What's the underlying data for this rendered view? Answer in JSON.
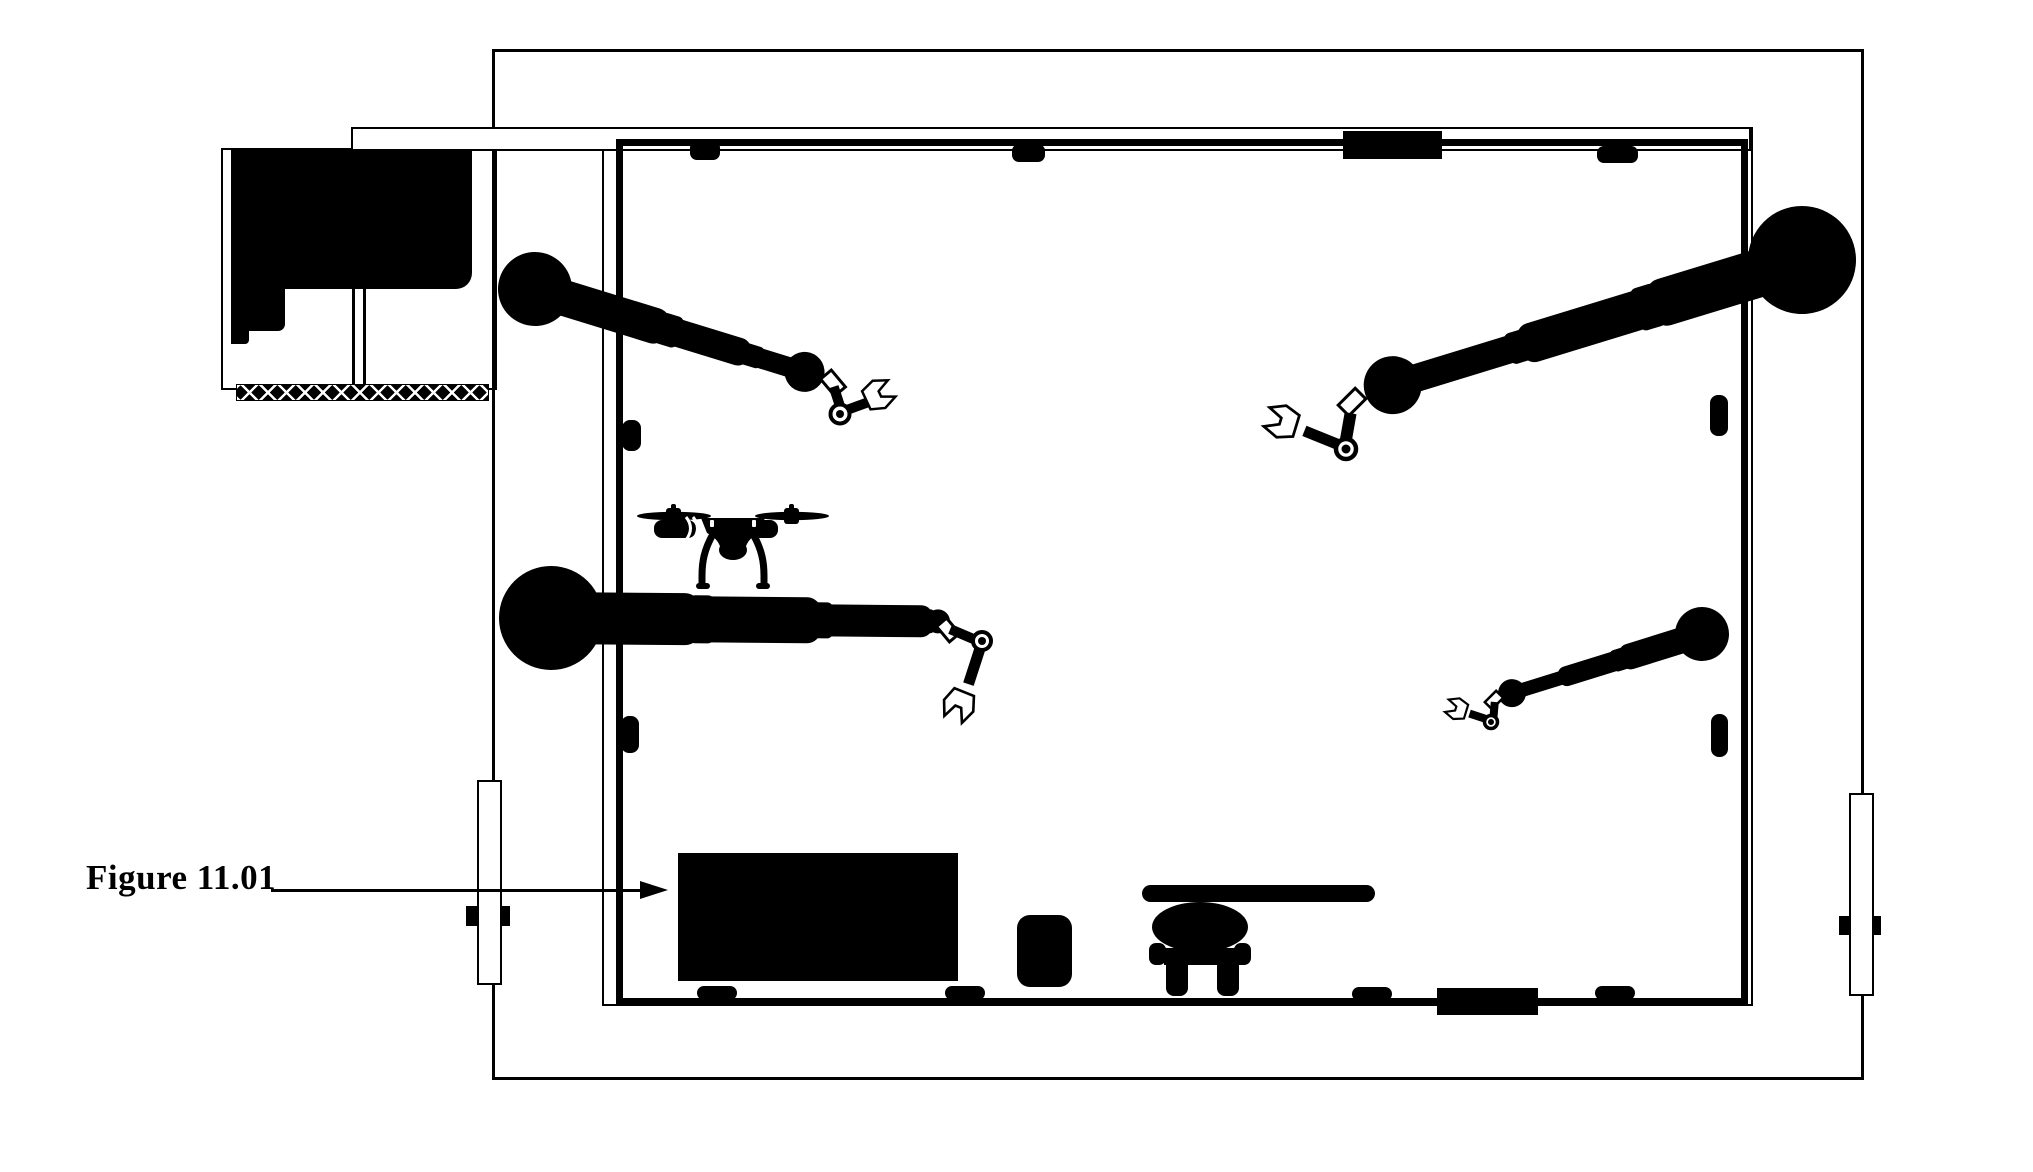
{
  "figure": {
    "label": "Figure 11.01"
  },
  "palette": {
    "ink": "#000000",
    "paper": "#ffffff"
  },
  "scene": {
    "type": "floor-plan figure",
    "robot_arm_count": 4,
    "drone_count": 1,
    "door_count": 2
  }
}
